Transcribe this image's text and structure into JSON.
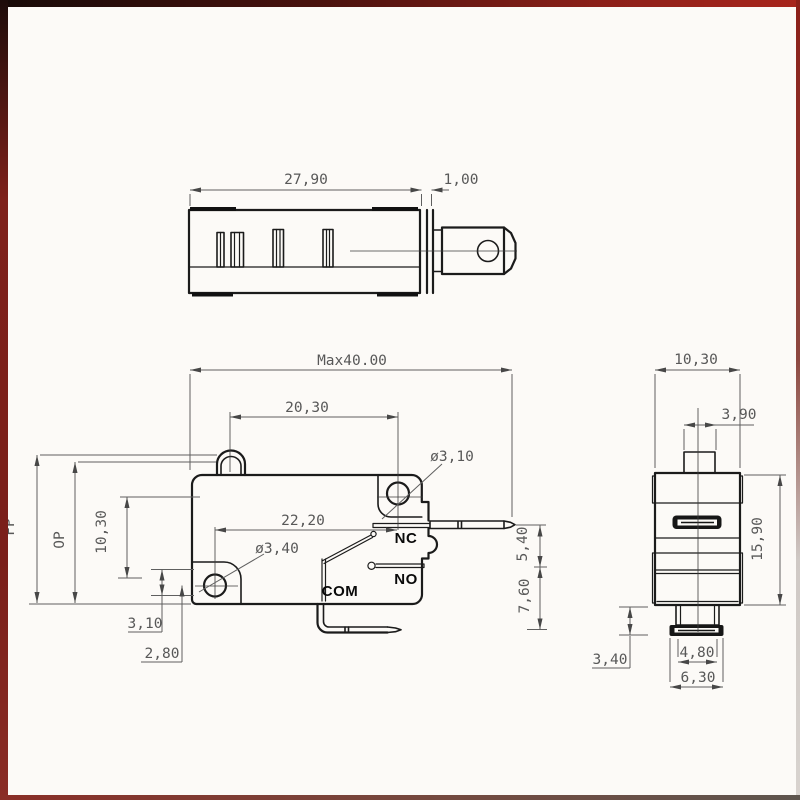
{
  "views": {
    "top": {
      "dims": {
        "body_width": "27,90",
        "plate_width": "1,00"
      }
    },
    "front": {
      "dims": {
        "overall_length": "Max40.00",
        "button_to_hole": "20,30",
        "top_hole_dia": "ø3,10",
        "hole_spacing": "22,20",
        "bottom_hole_dia": "ø3,40",
        "free_position": "FP",
        "operating_position": "OP",
        "hole_center_height": "10,30",
        "hole_to_base": "3,10",
        "terminal_drop": "2,80",
        "nc_terminal_offset": "5,40",
        "com_terminal_offset": "7,60"
      },
      "terminal_labels": {
        "nc": "NC",
        "no": "NO",
        "com": "COM"
      }
    },
    "side": {
      "dims": {
        "body_width": "10,30",
        "button_width": "3,90",
        "body_height": "15,90",
        "terminal_height": "3,40",
        "terminal_width_inner": "4,80",
        "terminal_width_outer": "6,30"
      }
    }
  }
}
